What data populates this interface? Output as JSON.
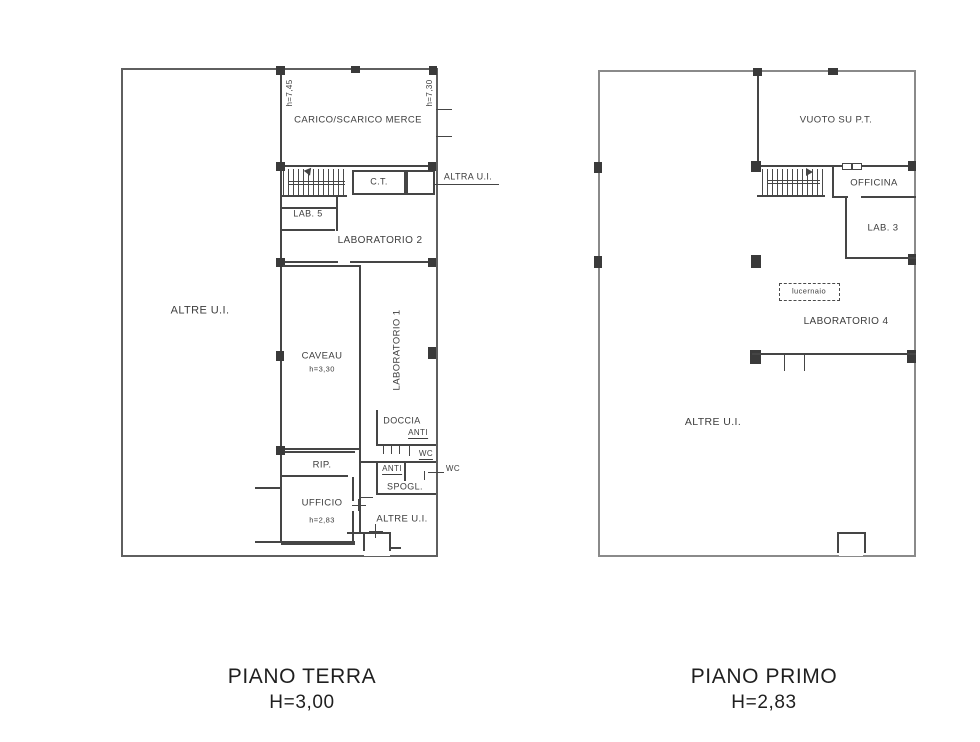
{
  "colors": {
    "background": "#ffffff",
    "wall": "#454545",
    "outer_wall": "#8a8a8a",
    "text": "#3d3d3d",
    "title_text": "#1f1f1f"
  },
  "plans": [
    {
      "id": "piano-terra",
      "title": "PIANO TERRA",
      "height_label": "H=3,00",
      "labels": {
        "altre_ui": "ALTRE U.I.",
        "carico_scarico": "CARICO/SCARICO MERCE",
        "h_745": "h=7,45",
        "h_730": "h=7,30",
        "ct": "C.T.",
        "altra_ui": "ALTRA U.I.",
        "lab5": "LAB. 5",
        "laboratorio2": "LABORATORIO 2",
        "caveau": "CAVEAU",
        "caveau_h": "h=3,30",
        "laboratorio1": "LABORATORIO 1",
        "doccia": "DOCCIA",
        "anti1": "ANTI",
        "wc1": "WC",
        "anti2": "ANTI",
        "wc2": "WC",
        "spogl": "SPOGL.",
        "rip": "RIP.",
        "ufficio": "UFFICIO",
        "ufficio_h": "h=2,83",
        "altre_ui_2": "ALTRE U.I."
      }
    },
    {
      "id": "piano-primo",
      "title": "PIANO PRIMO",
      "height_label": "H=2,83",
      "labels": {
        "vuoto": "VUOTO SU P.T.",
        "officina": "OFFICINA",
        "lab3": "LAB. 3",
        "lucernaio": "lucernaio",
        "laboratorio4": "LABORATORIO 4",
        "altre_ui": "ALTRE U.I."
      }
    }
  ]
}
